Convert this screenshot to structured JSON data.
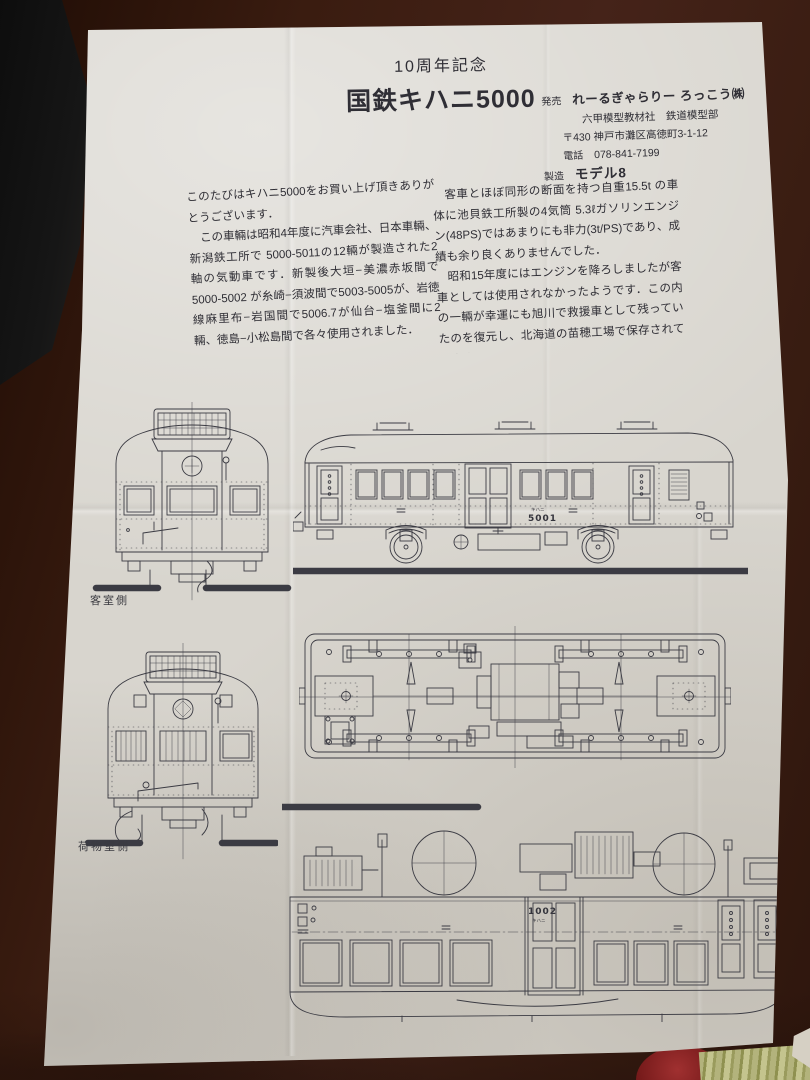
{
  "photo": {
    "table_color": "#3b1f15",
    "paper_color": "#d8d5ce",
    "ink_color": "#3b3b43",
    "red_object_color": "#8c2426",
    "green_object_color": "#a2a266"
  },
  "document": {
    "header": {
      "anniversary": "10周年記念",
      "title": "国鉄キハニ5000"
    },
    "publisher": {
      "sale_label": "発売",
      "sale_name": "れーるぎゃらりー ろっこう㈱",
      "sale_dept": "六甲模型教材社　鉄道模型部",
      "address": "〒430 神戸市灘区高徳町3-1-12",
      "tel_label": "電話",
      "tel_number": "078-841-7199",
      "mfg_label": "製造",
      "mfg_name": "モデル8"
    },
    "body_left": {
      "p1": "このたびはキハニ5000をお買い上げ頂きありがとうございます．",
      "p2": "　この車輛は昭和4年度に汽車会社、日本車輛、新潟鉄工所で 5000-5011の12輛が製造された2軸の気動車です．新製後大垣−美濃赤坂間で5000-5002 が糸崎−須波間で5003-5005が、岩徳線麻里布−岩国間で5006.7が仙台−塩釜間に2輛、徳島−小松島間で各々使用されました．"
    },
    "body_right": {
      "p1": "　客車とほぼ同形の断面を持つ自重15.5t の車体に池貝鉄工所製の4気筒 5.3ℓガソリンエンジン(48PS)ではあまりにも非力(3t/PS)であり、成績も余り良くありませんでした．",
      "p2": "　昭和15年度にはエンジンを降ろしましたが客車としては使用されなかったようです．この内の一輛が幸運にも旭川で救援車として残っていたのを復元し、北海道の苗穂工場で保存されています．"
    },
    "drawings": {
      "label_passenger_side": "客室側",
      "label_luggage_side": "荷物室側",
      "side_number_prefix": "キハニ",
      "side_number": "5001",
      "plan_number_prefix": "キハニ",
      "plan_number": "1002"
    }
  }
}
